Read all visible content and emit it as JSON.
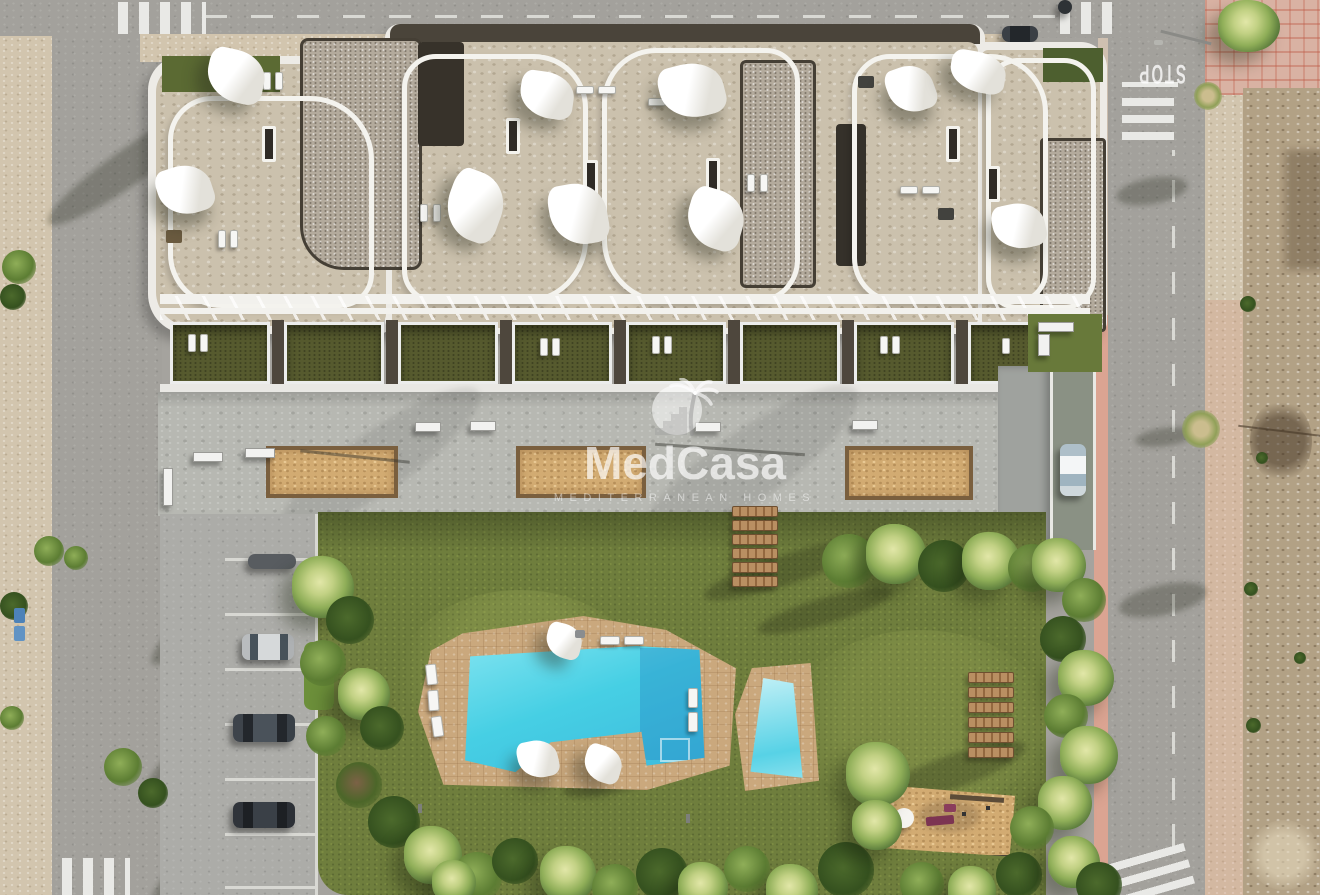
{
  "watermark": {
    "brand": "MedCasa",
    "tagline": "MEDITERRANEAN HOMES"
  },
  "road_markings": {
    "stop": "STOP"
  },
  "palette": {
    "road": "#a3a19c",
    "sidewalk_sand": "#d2c5ae",
    "dirt_lot": "#b2a185",
    "building_white": "#edebe6",
    "roof_beige": "#cbc1ad",
    "roof_gravel": "#b3aa9c",
    "terrace_green": "#565a2e",
    "plaza_concrete": "#b7b8b2",
    "lawn": "#6f7e3d",
    "pool_water": "#46cfe4",
    "deck_stone": "#caa87d",
    "sail_shade": "#f8f7f4",
    "planter_sand": "#d2ab72",
    "pink_pavement": "#dba492",
    "watermark_white": "rgba(255,255,255,0.68)"
  }
}
